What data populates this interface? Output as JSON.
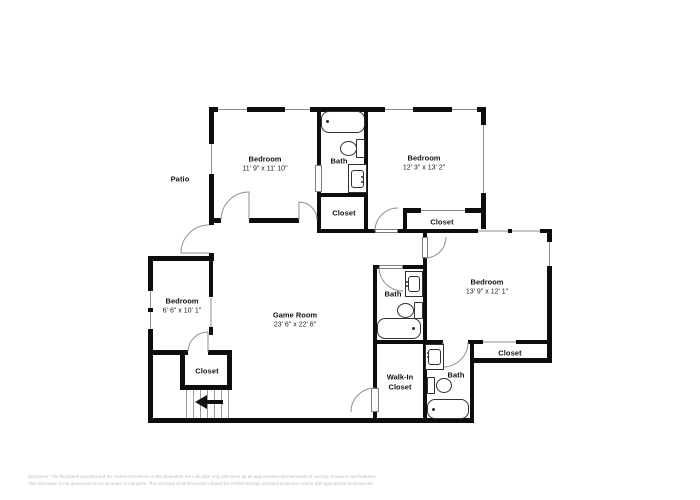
{
  "floorplan": {
    "patio_label": "Patio",
    "rooms": {
      "bedroom_top_left": {
        "name": "Bedroom",
        "dims": "11' 9\" x 11' 10\""
      },
      "bedroom_top_right": {
        "name": "Bedroom",
        "dims": "12' 3\" x 13' 2\""
      },
      "bedroom_right": {
        "name": "Bedroom",
        "dims": "13' 9\" x 12' 1\""
      },
      "bedroom_left": {
        "name": "Bedroom",
        "dims": "6' 6\" x 10' 1\""
      },
      "game_room": {
        "name": "Game Room",
        "dims": "23' 6\" x 22' 6\""
      },
      "bath_top": {
        "name": "Bath"
      },
      "bath_middle": {
        "name": "Bath"
      },
      "bath_bottom_right": {
        "name": "Bath"
      },
      "closet_top": {
        "name": "Closet"
      },
      "closet_top_right": {
        "name": "Closet"
      },
      "closet_right": {
        "name": "Closet"
      },
      "closet_bottom_left": {
        "name": "Closet"
      },
      "walk_in_closet": {
        "name": "Walk-In Closet"
      }
    },
    "stairs": {
      "arrow_direction": "left"
    },
    "icons": {
      "stairs_arrow": "left-arrow",
      "fixtures": [
        "bathtub",
        "toilet",
        "sink-vanity"
      ]
    },
    "colors": {
      "wall": "#0d0d0d",
      "fixture_stroke": "#303030",
      "door_arc": "#8f8f8f",
      "disclaimer_text": "#bdbdbd",
      "background": "#ffffff"
    },
    "disclaimer": {
      "line1": "Disclaimer: The floorplans depicted and the stated dimensions in this illustration are indicative only and serve as an approximate representation of existing structures and features.",
      "line2": "This illustration is not guaranteed to be accurate or complete. The accuracy of all information should be verified through personal inspection and/or with appropriate professionals."
    }
  }
}
